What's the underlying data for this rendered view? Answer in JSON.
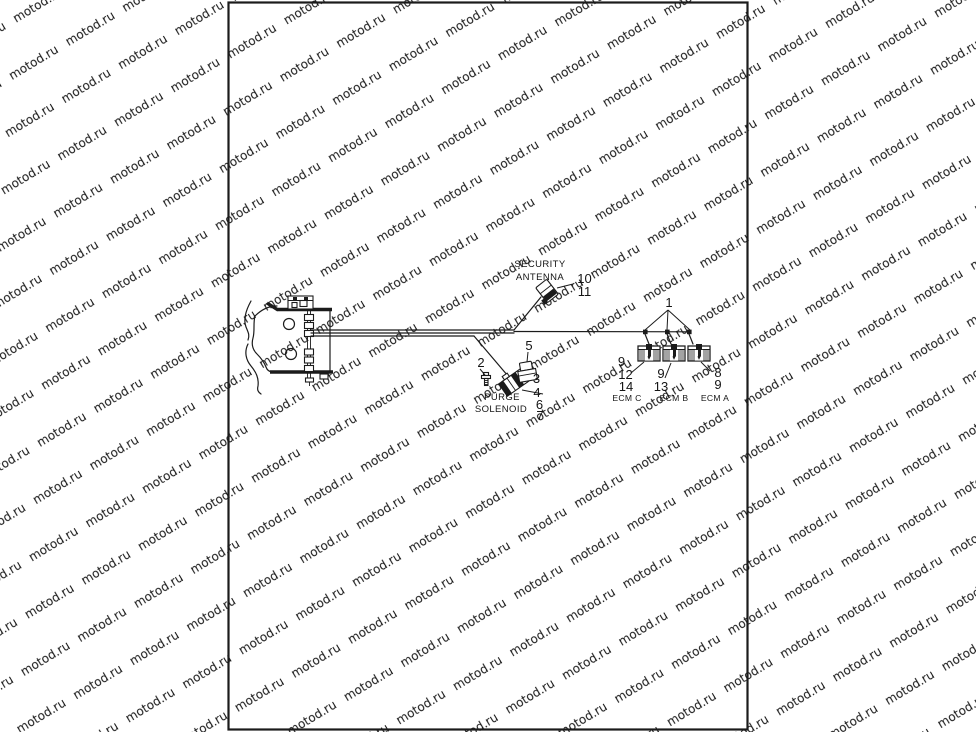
{
  "watermark": {
    "text": "motod.ru",
    "color": "#d2d2d2"
  },
  "diagram": {
    "type": "motorcycle-wiring-harness-parts-diagram",
    "labels": {
      "security_antenna_line1": "SECURITY",
      "security_antenna_line2": "ANTENNA",
      "purge_line1": "PURGE",
      "purge_line2": "SOLENOID",
      "ecm_c": "ECM C",
      "ecm_b": "ECM B",
      "ecm_a": "ECM A"
    },
    "callouts": {
      "harness": "1",
      "screw": "2",
      "item3": "3",
      "item4": "4",
      "item5": "5",
      "item6": "6",
      "item7": "7",
      "item8": "8",
      "item9_ecm_c": "9",
      "item9_ecm_b": "9",
      "item9_ecm_a": "9",
      "item10": "10",
      "item11": "11",
      "item12": "12",
      "item13": "13",
      "item14": "14"
    }
  }
}
